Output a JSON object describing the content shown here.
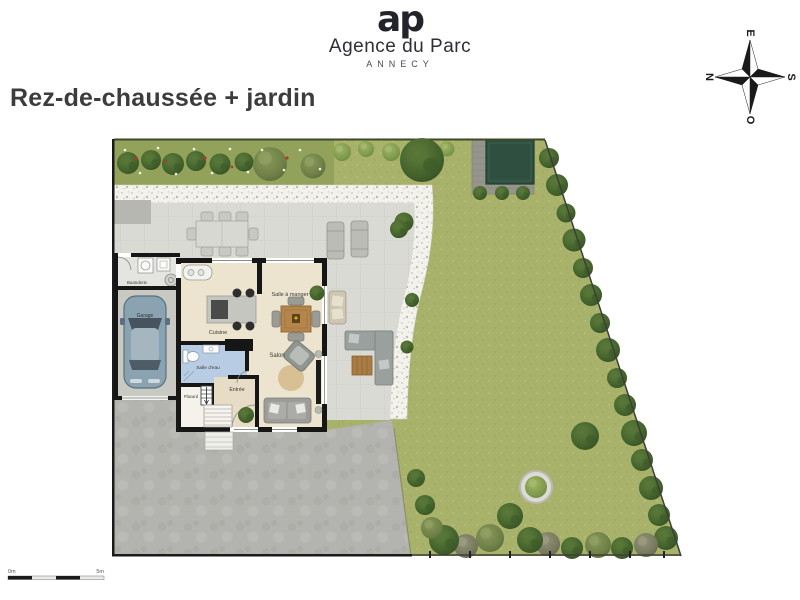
{
  "brand": {
    "monogram": "ap",
    "name": "Agence du Parc",
    "city": "ANNECY"
  },
  "title": "Rez-de-chaussée + jardin",
  "compass": {
    "n": "N",
    "e": "E",
    "s": "S",
    "o": "O"
  },
  "plan": {
    "type": "ground-floor-and-garden-plan",
    "rooms": {
      "buanderie": "Buanderie",
      "garage": "Garage",
      "cuisine": "Cuisine",
      "salle_a_manger": "Salle à manger",
      "salon": "Salon",
      "salle_deau": "Salle d'eau",
      "entree": "Entrée",
      "placard": "Placard"
    },
    "scale_bar": {
      "start": "0m",
      "end": "5m"
    },
    "colors": {
      "lawn": "#a9b26b",
      "flowerbed": "#93a25a",
      "gravel": "#f3f2ec",
      "terrace": "#dadad5",
      "driveway": "#b3b3af",
      "pool": "#2f4f40",
      "deck": "#95958b",
      "walls": "#161616",
      "floor": "#ece4ce",
      "bathroom_floor": "#b8cce4",
      "wood": "#b5854c"
    }
  }
}
